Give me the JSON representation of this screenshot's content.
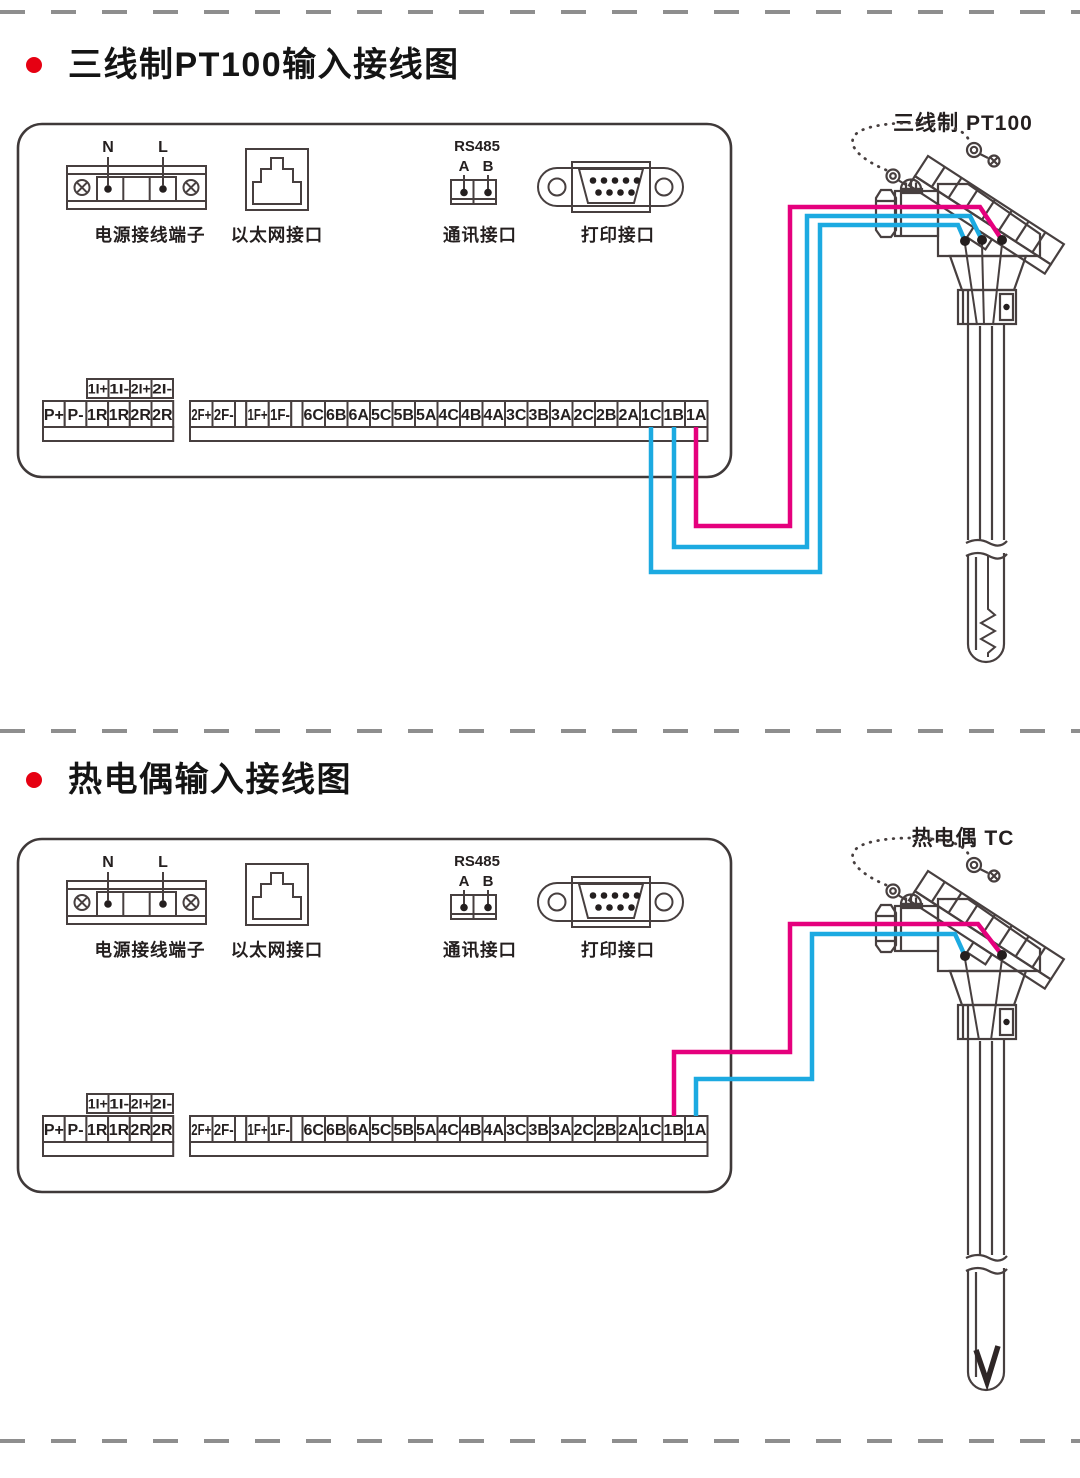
{
  "colors": {
    "art_line": "#473f3f",
    "text": "#241f1f",
    "panel_frame": "#3f3939",
    "wire_pink": "#e5007d",
    "wire_blue": "#1caae1",
    "bullet_red": "#e60012",
    "dash_gray": "#8e8e8e"
  },
  "sections": [
    {
      "id": "pt100",
      "title": "三线制PT100输入接线图",
      "sensor_label": "三线制 PT100",
      "sensor_type": "rtd-resistor-tip",
      "wires": [
        {
          "terminal": "1C",
          "color": "blue"
        },
        {
          "terminal": "1B",
          "color": "blue"
        },
        {
          "terminal": "1A",
          "color": "pink"
        }
      ]
    },
    {
      "id": "tc",
      "title": "热电偶输入接线图",
      "sensor_label": "热电偶 TC",
      "sensor_type": "thermocouple-v-tip",
      "wires": [
        {
          "terminal": "1B",
          "color": "pink"
        },
        {
          "terminal": "1A",
          "color": "blue"
        }
      ]
    }
  ],
  "panel": {
    "power": {
      "label": "电源接线端子",
      "pins": [
        "N",
        "L"
      ]
    },
    "ethernet": {
      "label": "以太网接口"
    },
    "comm": {
      "label": "通讯接口",
      "bus": "RS485",
      "pins": [
        "A",
        "B"
      ]
    },
    "printer": {
      "label": "打印接口"
    },
    "strips": {
      "upper": [
        "1I+",
        "1I-",
        "2I+",
        "2I-"
      ],
      "left": [
        "P+",
        "P-",
        "1R",
        "1R",
        "2R",
        "2R"
      ],
      "right": [
        "2F+",
        "2F-",
        "",
        "1F+",
        "1F-",
        "",
        "6C",
        "6B",
        "6A",
        "5C",
        "5B",
        "5A",
        "4C",
        "4B",
        "4A",
        "3C",
        "3B",
        "3A",
        "2C",
        "2B",
        "2A",
        "1C",
        "1B",
        "1A"
      ]
    }
  }
}
